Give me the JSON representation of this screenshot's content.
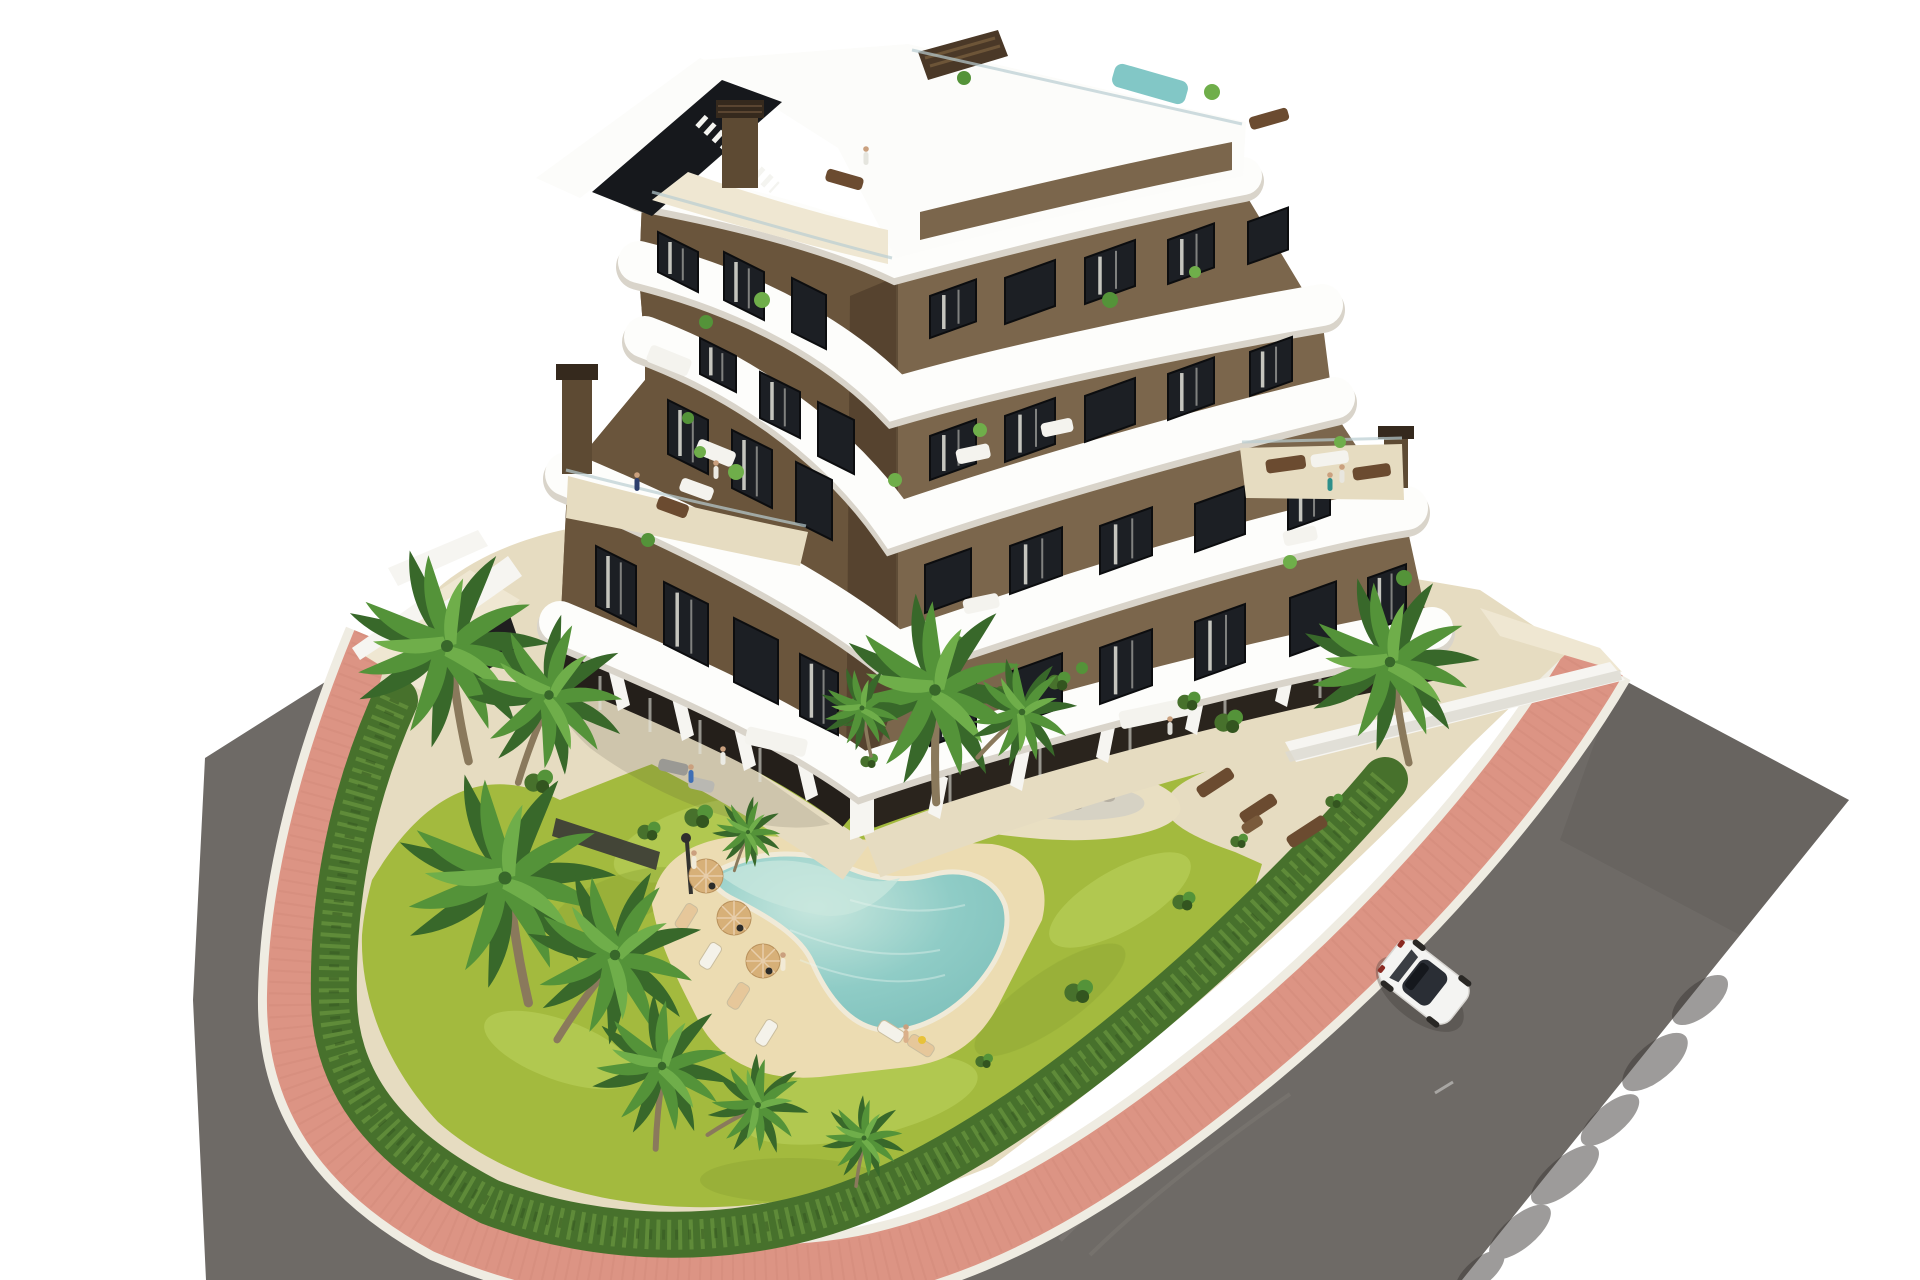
{
  "scene": {
    "type": "3d-architectural-rendering",
    "setting": "aerial daylight view of a modern residential apartment complex with communal garden, lagoon pool and surrounding streets",
    "visible_text": ""
  },
  "inventory": [
    {
      "name": "apartment-building",
      "details": "7-storey stepped volume, brown stucco facades, white curved wrap-around balcony bands, glass railings, roof terraces with residents, two wing chimneys"
    },
    {
      "name": "rooftop-pool",
      "details": "small turquoise plunge pool on the white roof deck"
    },
    {
      "name": "swimming-pool",
      "details": "free-form lagoon style pool with sandy beach deck"
    },
    {
      "name": "garden",
      "details": "yellow-green lawn, planting island with palms and rocks, perimeter hedges"
    },
    {
      "name": "palm-trees",
      "count": 12
    },
    {
      "name": "parasols",
      "count": 3
    },
    {
      "name": "sun-loungers",
      "count": 6
    },
    {
      "name": "residents",
      "count": 11
    },
    {
      "name": "pedestrian-path",
      "details": "salmon brick paved walkway with white curbs wrapping the plot"
    },
    {
      "name": "road",
      "details": "grey asphalt street on two sides with tree shadows and tyre scuffs"
    },
    {
      "name": "car",
      "details": "white sedan driving on the right-hand road",
      "count": 1
    }
  ],
  "colors": {
    "background": "#ffffff",
    "road": "#6e6a66",
    "road_dark": "#57534f",
    "road_scuff": "#948f8a",
    "path_pink": "#dc9484",
    "path_pink_dark": "#c97f6f",
    "curb": "#efece2",
    "pavement": "#e6dcc1",
    "pavement_light": "#efe7d2",
    "lawn": "#a3ba3e",
    "lawn_light": "#bed360",
    "lawn_dark": "#8aa332",
    "hedge": "#47712c",
    "hedge_dark": "#33551f",
    "hedge_light": "#6f9c42",
    "sand": "#ecdcb2",
    "island_sand": "#e9dfc2",
    "pebble": "#d6d2c4",
    "pool_water": "#8fccc6",
    "pool_water_light": "#c8e7de",
    "pool_edge": "#f0ead8",
    "facade_left": "#6a553c",
    "facade_right": "#7b664c",
    "facade_shadow": "#3f2f20",
    "band_white": "#fdfdfb",
    "band_shadow": "#d9d4ca",
    "window_glass": "#1c1f24",
    "window_frame": "#0c0d0f",
    "curtain": "#e3e2da",
    "glass_rail": "#b9cdd2",
    "roof_white": "#fcfcfa",
    "rooftop_pool": "#82c7c6",
    "chimney": "#5d4a33",
    "chimney_cap": "#35291d",
    "wall_white": "#f6f5f1",
    "gate_dark": "#1f1f1f",
    "fence_dark": "#3b3b36",
    "palm_green": "#549339",
    "palm_green_dark": "#38682a",
    "palm_green_light": "#6fae4a",
    "palm_trunk": "#8a795c",
    "parasol": "#d7b078",
    "lounger_white": "#f4f2ea",
    "lounger_tan": "#e6c79a",
    "furniture_brown": "#6b4b30",
    "furniture_white": "#f4f3ee",
    "people_skin": "#caa07e",
    "car_body": "#f4f4f2",
    "car_glass": "#2a2e35",
    "car_shadow": "#3e3a37",
    "shadow_soft": "#4a4434"
  }
}
